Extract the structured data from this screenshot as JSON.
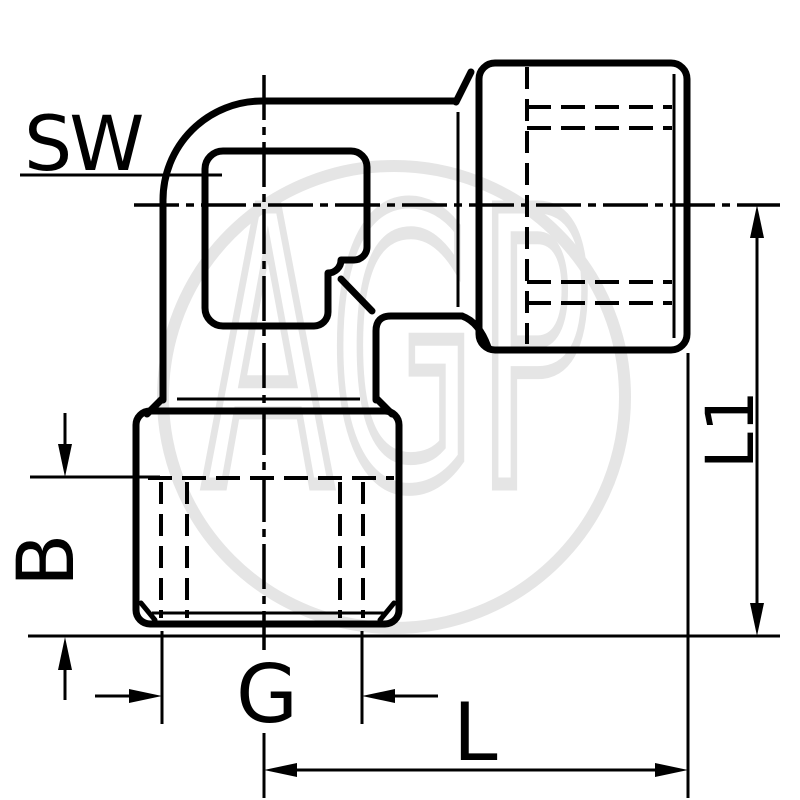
{
  "drawing": {
    "watermark_text": "AGP",
    "labels": {
      "sw": "SW",
      "b": "B",
      "g": "G",
      "l": "L",
      "l1": "L1"
    },
    "colors": {
      "line": "#000000",
      "watermark": "#e5e5e5",
      "background": "#ffffff"
    }
  }
}
